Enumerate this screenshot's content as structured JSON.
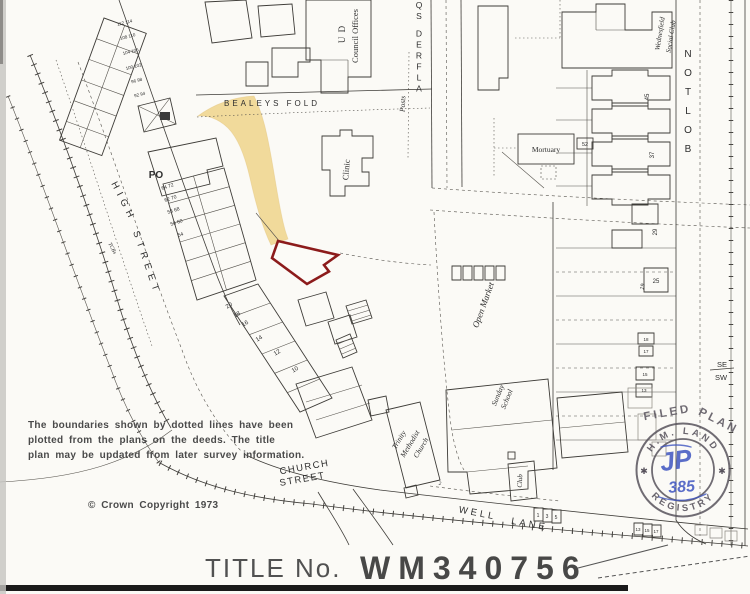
{
  "colors": {
    "wash": "#f1d894",
    "plot": "#8c1b1b",
    "stampink": "#57525c",
    "pen": "#3f55c0"
  },
  "title_block": {
    "label": "TITLE No.",
    "number": "WM340756"
  },
  "notes": {
    "line1": "The boundaries shown by dotted lines have been",
    "line2": "plotted from the plans on the deeds.  The title",
    "line3": "plan may be updated from later survey information.",
    "copyright": "©  Crown Copyright  1973"
  },
  "stamp": {
    "filed": "FILED",
    "plan": "PLAN",
    "ring_top": "H.M. LAND",
    "ring_bottom": "REGISTRY",
    "star": "✱",
    "monogram": "JP",
    "number": "385"
  },
  "map": {
    "labels": [
      {
        "n": "bealeys-fold",
        "t": "BEALEYS  FOLD",
        "x": 272,
        "y": 106,
        "s": 8,
        "ls": 3
      },
      {
        "n": "high",
        "t": "HIGH",
        "x": 121,
        "y": 203,
        "r": 63,
        "s": 9.5,
        "ls": 5
      },
      {
        "n": "high-street",
        "t": "STREET",
        "x": 144,
        "y": 264,
        "r": 71,
        "s": 9.5,
        "ls": 5
      },
      {
        "n": "church-street-1",
        "t": "CHURCH",
        "x": 305,
        "y": 470,
        "r": -10,
        "s": 9.5,
        "ls": 1.5
      },
      {
        "n": "church-street-2",
        "t": "STREET",
        "x": 303,
        "y": 482,
        "r": -10,
        "s": 9.5,
        "ls": 1.5
      },
      {
        "n": "well",
        "t": "WELL",
        "x": 477,
        "y": 516,
        "r": 11,
        "s": 9.5,
        "ls": 3
      },
      {
        "n": "lane",
        "t": "LANE",
        "x": 529,
        "y": 527,
        "r": 10,
        "s": 9.5,
        "ls": 3
      },
      {
        "n": "alfred-sq",
        "t": "ALFRED SQ",
        "x": 419,
        "y": 8,
        "s": 8.5,
        "stack": 11,
        "up": true
      },
      {
        "n": "bolton-road",
        "t": "BOLTON",
        "x": 688,
        "y": 57,
        "s": 10,
        "stack": 19,
        "up": true
      },
      {
        "n": "ud",
        "t": "U D",
        "x": 345,
        "y": 34,
        "r": -90,
        "s": 9,
        "st": "serif",
        "ls": 1
      },
      {
        "n": "council-offices",
        "t": "Council Offices",
        "x": 358,
        "y": 36,
        "r": -90,
        "s": 8.5,
        "st": "serif"
      },
      {
        "n": "posts",
        "t": "Posts",
        "x": 405,
        "y": 104,
        "r": -87,
        "s": 7.5,
        "st": "si"
      },
      {
        "n": "clinic",
        "t": "Clinic",
        "x": 349,
        "y": 170,
        "r": -85,
        "s": 8.5,
        "st": "serif"
      },
      {
        "n": "mortuary",
        "t": "Mortuary",
        "x": 546,
        "y": 152,
        "s": 7.5,
        "st": "serif"
      },
      {
        "n": "wednesfield",
        "t": "Wednesfield",
        "x": 662,
        "y": 34,
        "r": -81,
        "s": 7,
        "st": "si"
      },
      {
        "n": "social-club",
        "t": "Social Club",
        "x": 673,
        "y": 37,
        "r": -81,
        "s": 7,
        "st": "si"
      },
      {
        "n": "open-market",
        "t": "Open Market",
        "x": 486,
        "y": 306,
        "r": -70,
        "s": 9,
        "st": "si"
      },
      {
        "n": "sunday",
        "t": "Sunday",
        "x": 500,
        "y": 396,
        "r": -68,
        "s": 7.5,
        "st": "si"
      },
      {
        "n": "sunday-school",
        "t": "School",
        "x": 509,
        "y": 400,
        "r": -68,
        "s": 7.5,
        "st": "si"
      },
      {
        "n": "trinity",
        "t": "Trinity",
        "x": 401,
        "y": 441,
        "r": -59,
        "s": 7.5,
        "st": "si"
      },
      {
        "n": "methodist",
        "t": "Methodist",
        "x": 412,
        "y": 445,
        "r": -59,
        "s": 7.5,
        "st": "si"
      },
      {
        "n": "church",
        "t": "Church",
        "x": 423,
        "y": 449,
        "r": -59,
        "s": 7.5,
        "st": "si"
      },
      {
        "n": "club",
        "t": "Club",
        "x": 522,
        "y": 481,
        "r": -87,
        "s": 7,
        "st": "si"
      },
      {
        "n": "po",
        "t": "PO",
        "x": 156,
        "y": 178,
        "s": 10,
        "st": "b"
      },
      {
        "n": "se",
        "t": "SE",
        "x": 722,
        "y": 367,
        "s": 7.5
      },
      {
        "n": "sw",
        "t": "SW",
        "x": 721,
        "y": 380,
        "s": 7.5
      },
      {
        "n": "tcbs",
        "t": "TCBs",
        "x": 111,
        "y": 249,
        "r": 62,
        "s": 5.5,
        "st": "si"
      },
      {
        "n": "no-112-114",
        "t": "112 114",
        "x": 125,
        "y": 24,
        "r": -14,
        "s": 4.5
      },
      {
        "n": "no-108-110",
        "t": "108 110",
        "x": 128,
        "y": 38,
        "r": -14,
        "s": 4.5
      },
      {
        "n": "no-104-106",
        "t": "104 106",
        "x": 131,
        "y": 53,
        "r": -14,
        "s": 4.5
      },
      {
        "n": "no-100-102",
        "t": "100 102",
        "x": 134,
        "y": 68,
        "r": -14,
        "s": 4.5
      },
      {
        "n": "no-96-98",
        "t": "96 98",
        "x": 137,
        "y": 82,
        "r": -14,
        "s": 4.5
      },
      {
        "n": "no-92-94",
        "t": "92 94",
        "x": 140,
        "y": 96,
        "r": -14,
        "s": 4.5
      },
      {
        "n": "no-64-72",
        "t": "64 72",
        "x": 168,
        "y": 188,
        "r": -18,
        "s": 5
      },
      {
        "n": "no-62-70",
        "t": "62 70",
        "x": 171,
        "y": 200,
        "r": -18,
        "s": 5
      },
      {
        "n": "no-58-68",
        "t": "58 68",
        "x": 174,
        "y": 212,
        "r": -18,
        "s": 5
      },
      {
        "n": "no-56-60",
        "t": "56 60",
        "x": 177,
        "y": 224,
        "r": -18,
        "s": 5
      },
      {
        "n": "no-54",
        "t": "54",
        "x": 181,
        "y": 236,
        "r": -18,
        "s": 5
      },
      {
        "n": "no-20",
        "t": "20",
        "x": 230,
        "y": 307,
        "r": -32,
        "s": 6
      },
      {
        "n": "no-18",
        "t": "18",
        "x": 238,
        "y": 316,
        "r": -32,
        "s": 6
      },
      {
        "n": "no-16",
        "t": "16",
        "x": 246,
        "y": 325,
        "r": -32,
        "s": 6
      },
      {
        "n": "no-14",
        "t": "14",
        "x": 260,
        "y": 340,
        "r": -32,
        "s": 6
      },
      {
        "n": "no-12",
        "t": "12",
        "x": 278,
        "y": 354,
        "r": -32,
        "s": 6
      },
      {
        "n": "no-10",
        "t": "10",
        "x": 296,
        "y": 371,
        "r": -32,
        "s": 6
      },
      {
        "n": "no-45",
        "t": "45",
        "x": 649,
        "y": 97,
        "r": -90,
        "s": 6
      },
      {
        "n": "no-37",
        "t": "37",
        "x": 654,
        "y": 155,
        "r": -90,
        "s": 6
      },
      {
        "n": "no-29",
        "t": "29",
        "x": 657,
        "y": 232,
        "r": -90,
        "s": 6
      },
      {
        "n": "no-25",
        "t": "25",
        "x": 656,
        "y": 283,
        "s": 6
      },
      {
        "n": "no-19",
        "t": "19",
        "x": 644,
        "y": 287,
        "r": -75,
        "s": 5.5
      },
      {
        "n": "no-18b",
        "t": "18",
        "x": 646,
        "y": 341,
        "s": 4.5
      },
      {
        "n": "no-17",
        "t": "17",
        "x": 646,
        "y": 353,
        "s": 4.5
      },
      {
        "n": "no-15",
        "t": "15",
        "x": 645,
        "y": 376,
        "s": 4.5
      },
      {
        "n": "no-13",
        "t": "13",
        "x": 644,
        "y": 392,
        "s": 4.5
      },
      {
        "n": "no-52",
        "t": "52",
        "x": 585,
        "y": 146,
        "s": 5.5
      },
      {
        "n": "no-2",
        "t": "2",
        "x": 440,
        "y": 485,
        "s": 5.5,
        "st": "si"
      },
      {
        "n": "no-1",
        "t": "1",
        "x": 538,
        "y": 517,
        "s": 5
      },
      {
        "n": "no-3",
        "t": "3",
        "x": 547,
        "y": 518,
        "s": 5
      },
      {
        "n": "no-5",
        "t": "5",
        "x": 556,
        "y": 519,
        "s": 5
      },
      {
        "n": "no-13w",
        "t": "13",
        "x": 638,
        "y": 531,
        "s": 4.5
      },
      {
        "n": "no-15w",
        "t": "15",
        "x": 647,
        "y": 532,
        "s": 4.5
      },
      {
        "n": "no-17w",
        "t": "17",
        "x": 656,
        "y": 533,
        "s": 4.5
      }
    ]
  }
}
